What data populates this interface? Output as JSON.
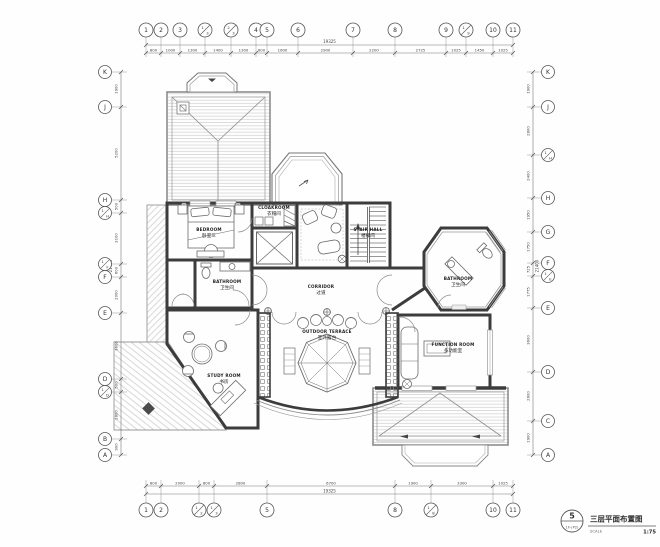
{
  "sheet": {
    "bg": "#fefefe",
    "wall_color": "#3c3c3c",
    "line_color": "#777777",
    "hatch_color": "#c7c7c7",
    "text_color": "#333333"
  },
  "title_block": {
    "sheet_number": "5",
    "sheet_code": "1F-(P2)",
    "title": "三层平面布置图",
    "scale_label": "SCALE",
    "scale_value": "1:75"
  },
  "grid": {
    "top": {
      "total": "19325",
      "axes": [
        {
          "label": "1",
          "pos": 146
        },
        {
          "label": "2",
          "pos": 161
        },
        {
          "label": "3",
          "pos": 180
        },
        {
          "label": "1/3",
          "pos": 205
        },
        {
          "label": "2/3",
          "pos": 231
        },
        {
          "label": "4",
          "pos": 256
        },
        {
          "label": "5",
          "pos": 267
        },
        {
          "label": "6",
          "pos": 298
        },
        {
          "label": "7",
          "pos": 353
        },
        {
          "label": "8",
          "pos": 395
        },
        {
          "label": "9",
          "pos": 446
        },
        {
          "label": "1/9",
          "pos": 466
        },
        {
          "label": "10",
          "pos": 493
        },
        {
          "label": "11",
          "pos": 513
        }
      ],
      "dims": [
        {
          "text": "800",
          "pos": 153.5
        },
        {
          "text": "1000",
          "pos": 170.5
        },
        {
          "text": "1300",
          "pos": 192.5
        },
        {
          "text": "1400",
          "pos": 218
        },
        {
          "text": "1300",
          "pos": 243.5
        },
        {
          "text": "600",
          "pos": 261.5
        },
        {
          "text": "1600",
          "pos": 282.5
        },
        {
          "text": "2900",
          "pos": 325.5
        },
        {
          "text": "2200",
          "pos": 374
        },
        {
          "text": "2725",
          "pos": 420.5
        },
        {
          "text": "1025",
          "pos": 456
        },
        {
          "text": "1450",
          "pos": 479.5
        },
        {
          "text": "1025",
          "pos": 503
        }
      ]
    },
    "bottom": {
      "total": "19325",
      "axes": [
        {
          "label": "1",
          "pos": 146
        },
        {
          "label": "2",
          "pos": 161
        },
        {
          "label": "1/2",
          "pos": 199
        },
        {
          "label": "1/3",
          "pos": 214
        },
        {
          "label": "5",
          "pos": 267
        },
        {
          "label": "8",
          "pos": 395
        },
        {
          "label": "1/8",
          "pos": 431
        },
        {
          "label": "10",
          "pos": 493
        },
        {
          "label": "11",
          "pos": 513
        }
      ],
      "dims": [
        {
          "text": "800",
          "pos": 153.5
        },
        {
          "text": "2000",
          "pos": 180
        },
        {
          "text": "800",
          "pos": 206.5
        },
        {
          "text": "2800",
          "pos": 240.5
        },
        {
          "text": "6700",
          "pos": 331
        },
        {
          "text": "1900",
          "pos": 413
        },
        {
          "text": "3300",
          "pos": 462
        },
        {
          "text": "1025",
          "pos": 503
        }
      ]
    },
    "left": {
      "total": "21400",
      "axes": [
        {
          "label": "K",
          "pos": 72
        },
        {
          "label": "J",
          "pos": 107
        },
        {
          "label": "H",
          "pos": 200
        },
        {
          "label": "1/H",
          "pos": 213
        },
        {
          "label": "1/F",
          "pos": 264
        },
        {
          "label": "F",
          "pos": 277
        },
        {
          "label": "E",
          "pos": 313
        },
        {
          "label": "D",
          "pos": 379
        },
        {
          "label": "1/D",
          "pos": 392
        },
        {
          "label": "B",
          "pos": 439
        },
        {
          "label": "A",
          "pos": 455
        }
      ],
      "dims": [
        {
          "text": "1900",
          "pos": 89
        },
        {
          "text": "5200",
          "pos": 153
        },
        {
          "text": "500",
          "pos": 206.5
        },
        {
          "text": "3100",
          "pos": 238
        },
        {
          "text": "600",
          "pos": 270.5
        },
        {
          "text": "2000",
          "pos": 295
        },
        {
          "text": "3600",
          "pos": 346
        },
        {
          "text": "500",
          "pos": 385
        },
        {
          "text": "2800",
          "pos": 415
        },
        {
          "text": "900",
          "pos": 447
        }
      ]
    },
    "right": {
      "total": "21400",
      "axes": [
        {
          "label": "K",
          "pos": 72
        },
        {
          "label": "J",
          "pos": 107
        },
        {
          "label": "1/H",
          "pos": 155
        },
        {
          "label": "H",
          "pos": 198
        },
        {
          "label": "G",
          "pos": 232
        },
        {
          "label": "F",
          "pos": 263
        },
        {
          "label": "1/E",
          "pos": 276
        },
        {
          "label": "E",
          "pos": 308
        },
        {
          "label": "D",
          "pos": 372
        },
        {
          "label": "C",
          "pos": 421
        },
        {
          "label": "A",
          "pos": 455
        }
      ],
      "dims": [
        {
          "text": "1900",
          "pos": 89
        },
        {
          "text": "2800",
          "pos": 131
        },
        {
          "text": "2400",
          "pos": 176
        },
        {
          "text": "1950",
          "pos": 215
        },
        {
          "text": "1750",
          "pos": 247
        },
        {
          "text": "725",
          "pos": 269.5
        },
        {
          "text": "1775",
          "pos": 292
        },
        {
          "text": "3600",
          "pos": 340
        },
        {
          "text": "2800",
          "pos": 396
        },
        {
          "text": "1900",
          "pos": 438
        }
      ]
    }
  },
  "rooms": [
    {
      "id": "bedroom",
      "en": "BEDROOM",
      "zh": "卧室三",
      "x": 209,
      "y": 231
    },
    {
      "id": "cloakroom",
      "en": "CLOAKROOM",
      "zh": "衣帽间",
      "x": 274,
      "y": 209
    },
    {
      "id": "stair-hall",
      "en": "STAIR HALL",
      "zh": "楼梯间",
      "x": 368,
      "y": 231
    },
    {
      "id": "bathroom-left",
      "en": "BATHROOM",
      "zh": "卫生间",
      "x": 227,
      "y": 283
    },
    {
      "id": "corridor",
      "en": "CORRIDOR",
      "zh": "过道",
      "x": 321,
      "y": 288
    },
    {
      "id": "outdoor-terrace",
      "en": "OUTDOOR TERRACE",
      "zh": "室外露台",
      "x": 327,
      "y": 333
    },
    {
      "id": "study-room",
      "en": "STUDY ROOM",
      "zh": "书房",
      "x": 224,
      "y": 377
    },
    {
      "id": "bathroom-right",
      "en": "BATHROOM",
      "zh": "卫生间",
      "x": 458,
      "y": 280
    },
    {
      "id": "function-room",
      "en": "FUNCTION ROOM",
      "zh": "多功能室",
      "x": 453,
      "y": 346
    }
  ]
}
